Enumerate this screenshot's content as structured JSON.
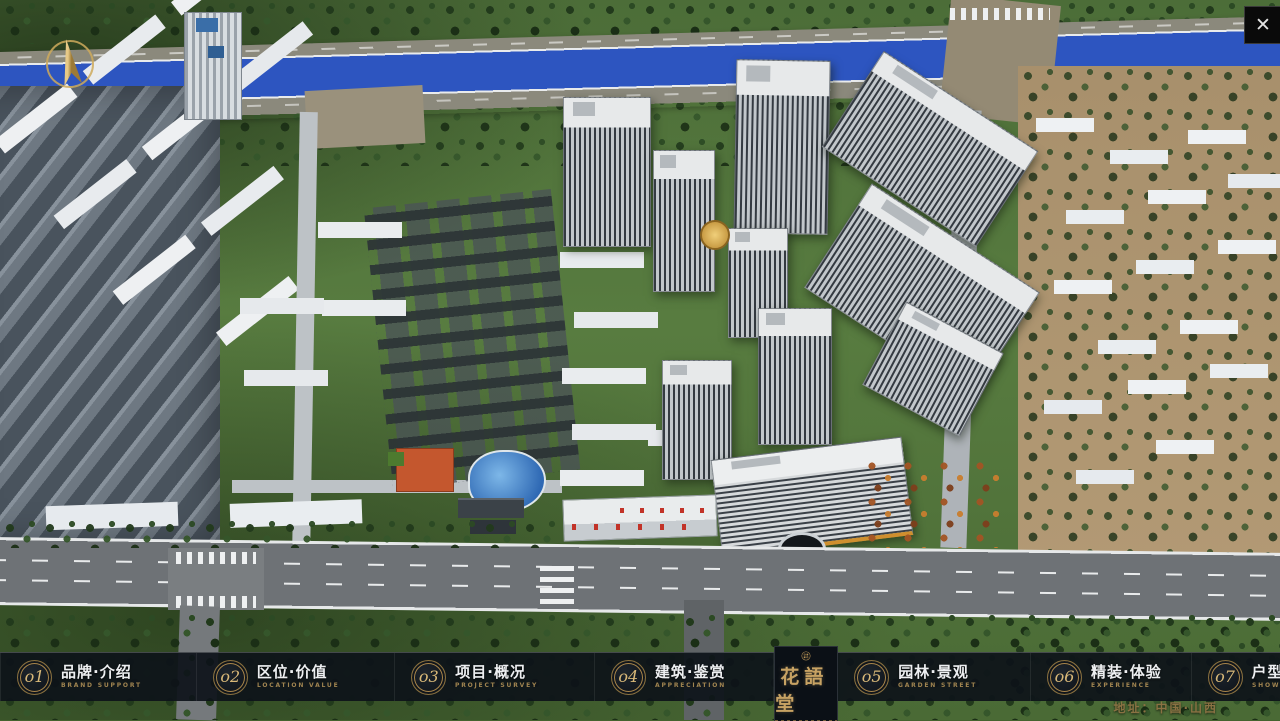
{
  "ui": {
    "close_glyph": "✕"
  },
  "nav": {
    "items": [
      {
        "num": "o1",
        "zh": "品牌·介绍",
        "en": "BRAND SUPPORT"
      },
      {
        "num": "o2",
        "zh": "区位·价值",
        "en": "LOCATION VALUE"
      },
      {
        "num": "o3",
        "zh": "项目·概况",
        "en": "PROJECT SURVEY"
      },
      {
        "num": "o4",
        "zh": "建筑·鉴赏",
        "en": "APPRECIATION"
      },
      {
        "num": "o5",
        "zh": "园林·景观",
        "en": "GARDEN STREET"
      },
      {
        "num": "o6",
        "zh": "精装·体验",
        "en": "EXPERIENCE"
      },
      {
        "num": "o7",
        "zh": "户型·分布",
        "en": "SHOW ROOM"
      },
      {
        "num": "o8",
        "zh": "一房·一景",
        "en": "COMMUNITY"
      }
    ]
  },
  "logo": {
    "title": "花語堂"
  },
  "footer": {
    "address": "地址：中国·山西"
  },
  "colors": {
    "gold": "#c7a263",
    "bar_background": "rgba(13,18,25,0.92)",
    "river_blue": "#2d55c0",
    "grass_green": "#587c40"
  }
}
